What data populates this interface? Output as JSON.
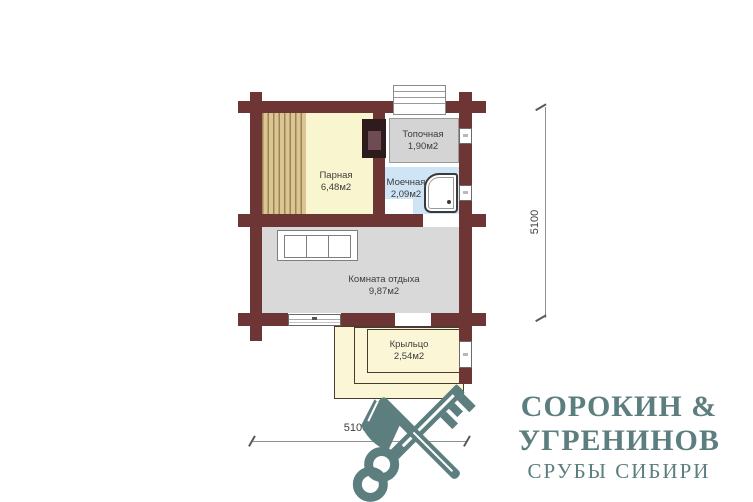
{
  "plan": {
    "rooms": {
      "parnaya": {
        "name": "Парная",
        "area": "6,48м2"
      },
      "topochnaya": {
        "name": "Топочная",
        "area": "1,90м2"
      },
      "moechnaya": {
        "name": "Моечная",
        "area": "2,09м2"
      },
      "rest": {
        "name": "Комната отдыха",
        "area": "9,87м2"
      },
      "porch": {
        "name": "Крыльцо",
        "area": "2,54м2"
      }
    },
    "dimensions": {
      "horizontal": "5100",
      "vertical": "5100"
    }
  },
  "logo": {
    "line1": "СОРОКИН &",
    "line2": "УГРЕНИНОВ",
    "line3": "СРУБЫ СИБИРИ"
  },
  "colors": {
    "wall": "#6e3535",
    "parnaya_fill": "#f9f5cf",
    "bench_wood": "#dbc592",
    "topochnaya_fill": "#d4d4d4",
    "moechnaya_fill": "#cfe4f4",
    "rest_fill": "#d9d9d9",
    "porch_fill": "#fbf7d6",
    "stove_outer": "#2e1b1b",
    "stove_inner": "#6f4b55",
    "logo_teal": "#5c7e7e"
  }
}
